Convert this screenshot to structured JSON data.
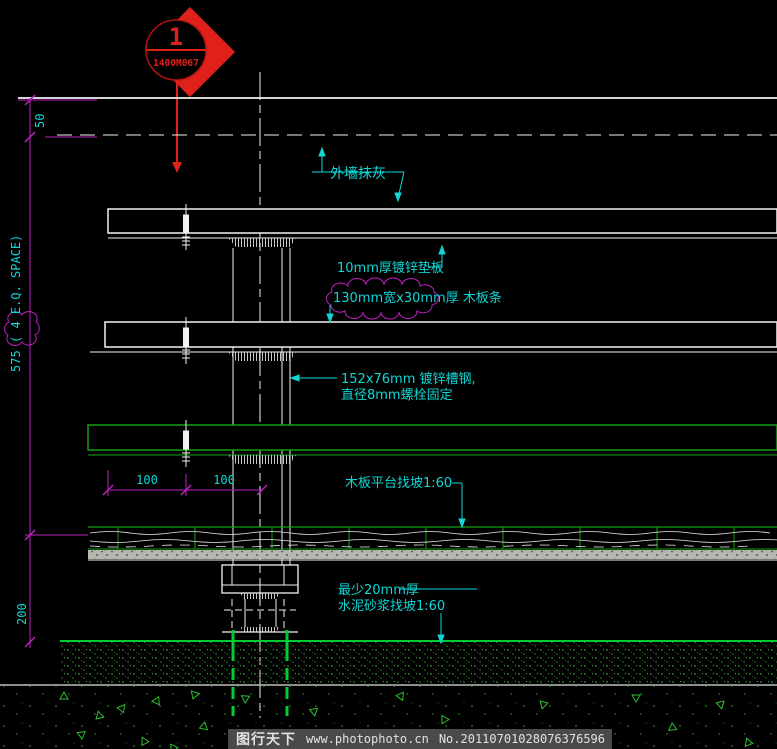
{
  "marker": {
    "number": "1",
    "code": "1400M067"
  },
  "dimensions": {
    "top_offset": "50",
    "rail_total": "575",
    "eq_note": "( 4  E.Q. SPACE)",
    "footing_depth": "200",
    "span_left": "100",
    "span_right": "100"
  },
  "annotations": {
    "wall_finish": "外墙抹灰",
    "plate": "10mm厚镀锌垫板",
    "plank": "130mm宽x30mm厚 木板条",
    "channel_line1": "152x76mm 镀锌槽钢,",
    "channel_line2": "直径8mm螺栓固定",
    "platform": "木板平台找坡1:60",
    "mortar_line1": "最少20mm厚",
    "mortar_line2": "水泥砂浆找坡1:60"
  },
  "watermark": {
    "site": "图行天下",
    "url": "www.photophoto.cn",
    "serial": "No.20110701028076376596"
  },
  "colors": {
    "line_white": "#f2f2f2",
    "dim_magenta": "#c01fc0",
    "text_cyan": "#10d6d6",
    "rail_green": "#12a012",
    "bright_green": "#00cd33",
    "marker_red": "#e0201a",
    "hatch_gray": "#c8c8c8"
  }
}
